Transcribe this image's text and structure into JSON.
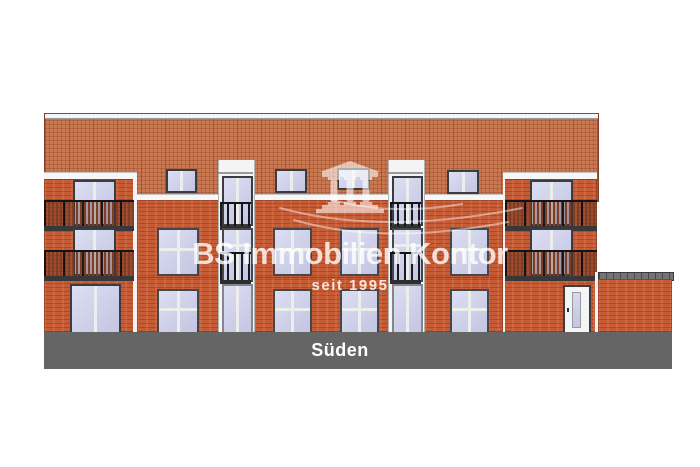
{
  "elevation": {
    "label": "Süden"
  },
  "watermark": {
    "brand": "BS Immobilien Kontor",
    "tagline": "seit 1995",
    "logo_icon": "portico-columns"
  },
  "colors": {
    "brick": "#c65c36",
    "roof": "#c97950",
    "glass": "#c7c9e6",
    "trim": "#f4f4f4",
    "ground_band": "#656565",
    "railing": "#17171a",
    "railing_wood": "#7d3e26",
    "watermark": "#ffffff"
  }
}
